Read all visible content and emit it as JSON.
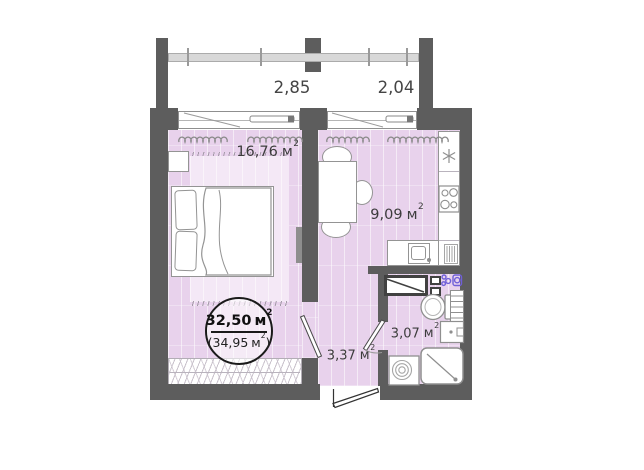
{
  "plan_type": "apartment-floor-plan",
  "dimensions": {
    "left": "2,85",
    "right": "2,04"
  },
  "units": {
    "base": "м",
    "sup": "2"
  },
  "rooms": {
    "bedroom": {
      "value": "16,76"
    },
    "kitchen": {
      "value": "9,09"
    },
    "hallway": {
      "value": "3,37"
    },
    "bathroom": {
      "value": "3,07"
    }
  },
  "total": {
    "value": "32,50",
    "sub": "(34,95",
    "sub_close": ")"
  },
  "colors": {
    "wall": "#5d5d5d",
    "floor": "#e8d2ec",
    "rug": "#f4e8f6",
    "railing": "#d8d8d8",
    "accent_purple": "#6f5fd8",
    "text": "#3c3c3c"
  },
  "icons": {
    "fridge": "snowflake-icon",
    "laundry_hookup": "bubbles-icon",
    "washing_machine": "washing-machine-drum-icon"
  }
}
